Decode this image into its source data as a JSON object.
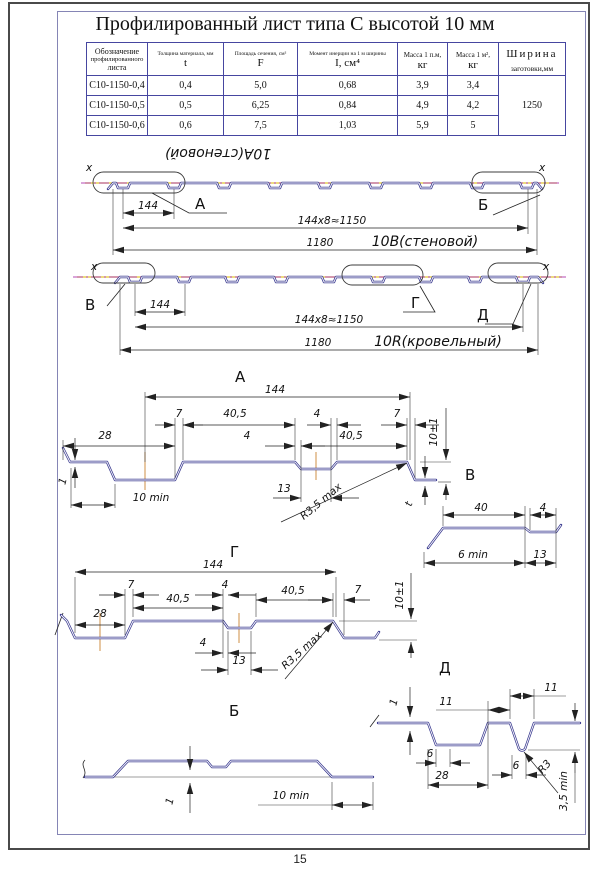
{
  "page": {
    "title": "Профилированный лист типа С высотой 10 мм",
    "number": "15"
  },
  "table": {
    "designation": [
      "Обозначение",
      "профилированного",
      "листа"
    ],
    "cols": [
      {
        "name": "Толщина материала, мм",
        "symbol": "t"
      },
      {
        "name": "Площадь сечения, см²",
        "symbol": "F"
      },
      {
        "name": "Момент инерции на 1 м ширины",
        "symbol": "I, см⁴"
      },
      {
        "name": "Масса 1 п.м,",
        "symbol": "кг"
      },
      {
        "name": "Масса 1 м²,",
        "symbol": "кг"
      }
    ],
    "width_col": {
      "line1": "Ширина",
      "line2": "заготовки,мм",
      "value": "1250"
    },
    "rows": [
      [
        "С10-1150-0,4",
        "0,4",
        "5,0",
        "0,68",
        "3,9",
        "3,4"
      ],
      [
        "С10-1150-0,5",
        "0,5",
        "6,25",
        "0,84",
        "4,9",
        "4,2"
      ],
      [
        "С10-1150-0,6",
        "0,6",
        "7,5",
        "1,03",
        "5,9",
        "5"
      ]
    ]
  },
  "strip1": {
    "flipped_name": "10А(стеновой)",
    "axis_left": "x",
    "axis_right": "x",
    "callout_a": "А",
    "callout_b": "Б",
    "dim_module": "144",
    "dim_total": "144х8≈1150",
    "dim_width": "1180",
    "name": "10В(стеновой)"
  },
  "strip2": {
    "axis_left": "x",
    "axis_right": "x",
    "callout_v": "В",
    "callout_g": "Г",
    "callout_d": "Д",
    "dim_module": "144",
    "dim_total": "144х8≈1150",
    "dim_width": "1180",
    "name": "10R(кровельный)"
  },
  "detail_a": {
    "label": "А",
    "d144": "144",
    "d7l": "7",
    "d405l": "40,5",
    "d4r": "4",
    "d7r": "7",
    "d28": "28",
    "d4c": "4",
    "d405r": "40,5",
    "d1": "1",
    "d10min": "10 min",
    "d13": "13",
    "radius": "R3,5 max",
    "height": "10±1",
    "thickness": "t"
  },
  "detail_v": {
    "label": "В",
    "d40": "40",
    "d4": "4",
    "d6min": "6 min",
    "d13": "13"
  },
  "detail_g": {
    "label": "Г",
    "d144": "144",
    "d7l": "7",
    "d405l": "40,5",
    "d4t": "4",
    "d405r": "40,5",
    "d7r": "7",
    "d28": "28",
    "d4b": "4",
    "d13": "13",
    "radius": "R3,5 max",
    "height": "10±1"
  },
  "detail_b": {
    "label": "Б",
    "d1": "1",
    "d10min": "10 min"
  },
  "detail_d": {
    "label": "Д",
    "d1": "1",
    "d11l": "11",
    "d11r": "11",
    "d6l": "6",
    "d28": "28",
    "d6r": "6",
    "radius": "R3",
    "d35min": "3,5 min"
  }
}
